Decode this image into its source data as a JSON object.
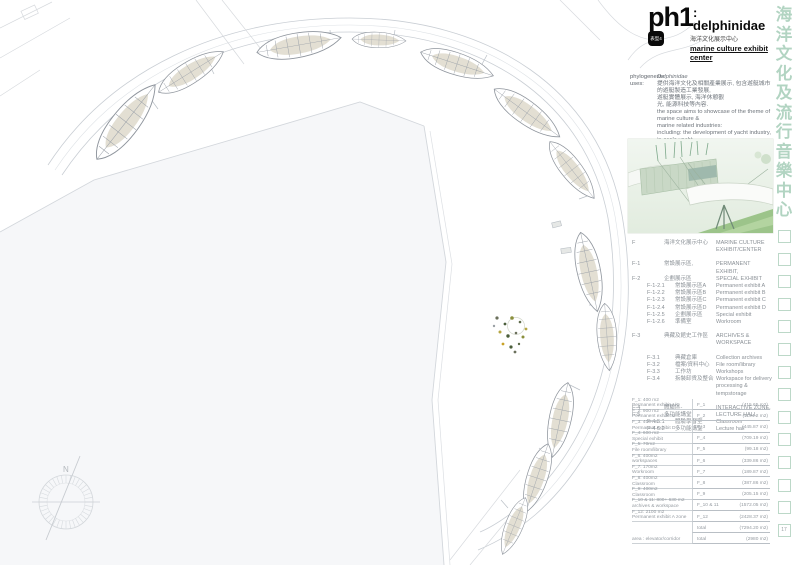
{
  "header": {
    "code": "ph1",
    "tag": "表型4",
    "title": ": delphinidae",
    "subtitle_zh": "海洋文化展示中心",
    "subtitle_en": "marine culture exhibit center"
  },
  "info": {
    "lines": [
      {
        "label": "phylogenesis:",
        "text": "Delphinidae",
        "cls": "it"
      },
      {
        "label": "uses:",
        "text": "提供海洋文化及相關產業展示, 包含遊艇城市的遊艇製造工業發展,",
        "cls": ""
      },
      {
        "label": "",
        "text": "遊艇實體展示, 海洋休憩觀",
        "cls": ""
      },
      {
        "label": "",
        "text": "光, 能源科技等內容.",
        "cls": ""
      },
      {
        "label": "",
        "text": "the space aims to showcase of the theme of marine culture &",
        "cls": ""
      },
      {
        "label": "",
        "text": "marine related industries:",
        "cls": ""
      },
      {
        "label": "",
        "text": "including: the development of yacht industry, in-scale yacht",
        "cls": ""
      },
      {
        "label": "",
        "text": "exhibit, marine recreation &",
        "cls": ""
      },
      {
        "label": "",
        "text": "tourism, and energy technologies.",
        "cls": ""
      },
      {
        "label": "scale:",
        "text": "1/1500",
        "cls": "gap"
      }
    ]
  },
  "program": {
    "rows": [
      {
        "code": "F",
        "zh": "海洋文化展示中心",
        "en": "MARINE CULTURE EXHIBIT/CENTER",
        "ind": 0,
        "sp": 0
      },
      {
        "code": "F-1",
        "zh": "常設展示區,",
        "en": "PERMANENT EXHIBIT,",
        "ind": 0,
        "sp": 1
      },
      {
        "code": "F-2",
        "zh": "企劃展示區",
        "en": "SPECIAL EXHIBIT",
        "ind": 0,
        "sp": 0
      },
      {
        "code": "F-1-2.1",
        "zh": "常設展示區A",
        "en": "Permanent exhibit A",
        "ind": 1,
        "sp": 0
      },
      {
        "code": "F-1-2.2",
        "zh": "常設展示區B",
        "en": "Permanent exhibit B",
        "ind": 1,
        "sp": 0
      },
      {
        "code": "F-1-2.3",
        "zh": "常設展示區C",
        "en": "Permanent exhibit C",
        "ind": 1,
        "sp": 0
      },
      {
        "code": "F-1-2.4",
        "zh": "常設展示區D",
        "en": "Permanent exhibit D",
        "ind": 1,
        "sp": 0
      },
      {
        "code": "F-1-2.5",
        "zh": "企劃展示區",
        "en": "Special exhibit",
        "ind": 1,
        "sp": 0
      },
      {
        "code": "F-1-2.6",
        "zh": "準備室",
        "en": "Workroom",
        "ind": 1,
        "sp": 0
      },
      {
        "code": "F-3",
        "zh": "典藏及館史工作區",
        "en": "ARCHIVES & WORKSPACE",
        "ind": 0,
        "sp": 1
      },
      {
        "code": "F-3.1",
        "zh": "典藏倉庫",
        "en": "Collection archives",
        "ind": 1,
        "sp": 1
      },
      {
        "code": "F-3.2",
        "zh": "檔案/資料中心",
        "en": "File room/library",
        "ind": 1,
        "sp": 0
      },
      {
        "code": "F-3.3",
        "zh": "工作坊",
        "en": "Workshops",
        "ind": 1,
        "sp": 0
      },
      {
        "code": "F-3.4",
        "zh": "拆裝卸貨及整合",
        "en": "Workspace for delivery processing & tempstorage",
        "ind": 1,
        "sp": 0
      },
      {
        "code": "F-4",
        "zh": "體驗區-",
        "en": "INTERACTIVE ZONE,",
        "ind": 0,
        "sp": 1
      },
      {
        "code": "F-5",
        "zh": "多功能講堂",
        "en": "LECTURE HALL",
        "ind": 0,
        "sp": 0
      },
      {
        "code": "F-4-5.1",
        "zh": "體驗學習室",
        "en": "Classroom",
        "ind": 1,
        "sp": 0
      },
      {
        "code": "F-4-5.2",
        "zh": "多功能講堂",
        "en": "Lecture hall",
        "ind": 1,
        "sp": 0
      }
    ]
  },
  "area_table": {
    "rows": [
      {
        "l1": "F_1: 400 m2",
        "l2": "Permanent exhibit A/C",
        "code": "F_1",
        "val": "(415.65 m2)"
      },
      {
        "l1": "F_2: 900 m2",
        "l2": "Permanent exhibit B",
        "code": "F_2",
        "val": "(1194.2 m2)"
      },
      {
        "l1": "F_3: 400 m2",
        "l2": "Permanent exhibit D",
        "code": "F_3",
        "val": "(445.87 m2)"
      },
      {
        "l1": "F_4: 600 m2",
        "l2": "Special exhibit",
        "code": "F_4",
        "val": "(709.19 m2)"
      },
      {
        "l1": "F_5: 70m2",
        "l2": "File room/library",
        "code": "F_5",
        "val": "(99.18 m2)"
      },
      {
        "l1": "F_6: 400m2",
        "l2": "workspaces",
        "code": "F_6",
        "val": "(339.86 m2)"
      },
      {
        "l1": "F_7: 170m2",
        "l2": "Workroom",
        "code": "F_7",
        "val": "(189.87 m2)"
      },
      {
        "l1": "F_8: 400m2",
        "l2": "Classroom",
        "code": "F_8",
        "val": "(387.86 m2)"
      },
      {
        "l1": "F_9: 400m2",
        "l2": "Classroom",
        "code": "F_9",
        "val": "(205.15 m2)"
      },
      {
        "l1": "F_10 & 11: 800+ 630 m2",
        "l2": "archives & workspace",
        "code": "F_10 & 11",
        "val": "(1572.05 m2)"
      },
      {
        "l1": "F_12: 2100 m2",
        "l2": "Permanent exhibit A zone",
        "code": "F_12",
        "val": "(2428.37 m2)"
      },
      {
        "l1": "",
        "l2": "",
        "code": "total",
        "val": "(7294.20 m2)"
      },
      {
        "l1": "area : elevator/corridor",
        "l2": "",
        "code": "total",
        "val": "(2980 m2)"
      }
    ]
  },
  "side_column": {
    "chars": [
      "海",
      "洋",
      "文",
      "化",
      "及",
      "流",
      "行",
      "音",
      "樂",
      "中",
      "心"
    ],
    "empty_square_count": 13,
    "page_number": "17",
    "accent_color": "#b2d4c2"
  },
  "compass": {
    "north_label": "N"
  }
}
